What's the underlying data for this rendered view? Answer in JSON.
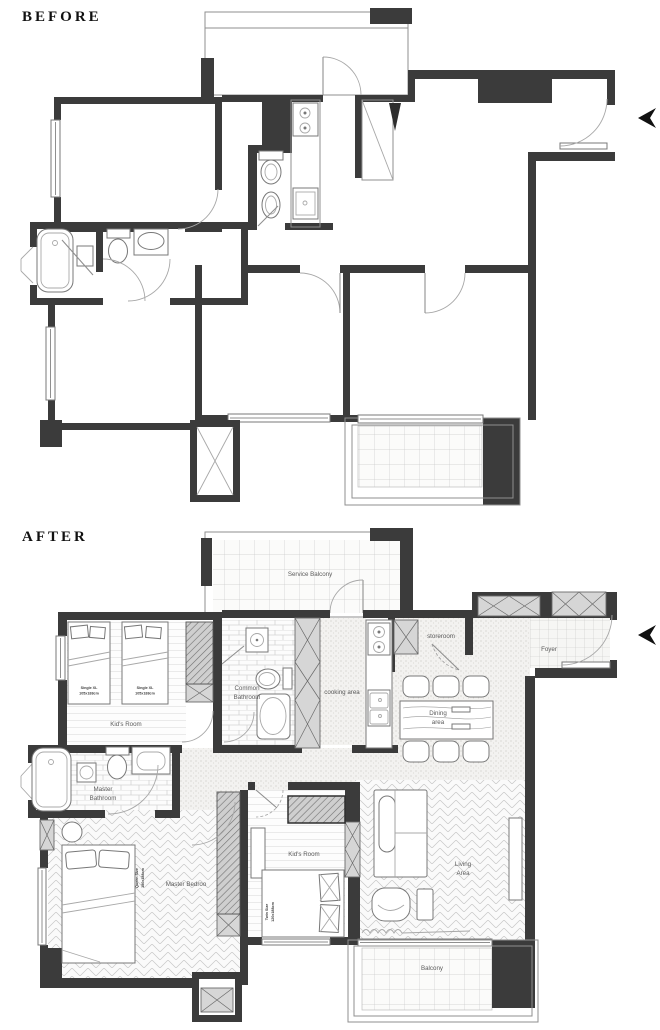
{
  "titles": {
    "before": "BEFORE",
    "after": "AFTER"
  },
  "after": {
    "rooms": {
      "service_balcony": "Service Balcony",
      "kids_room_1": "Kid's Room",
      "common_bathroom_line1": "Common",
      "common_bathroom_line2": "Bathroom",
      "cooking_area": "cooking area",
      "storeroom": "storeroom",
      "foyer": "Foyer",
      "dining_line1": "Dining",
      "dining_line2": "area",
      "master_bathroom_line1": "Master",
      "master_bathroom_line2": "Bathroom",
      "master_bedroom": "Master Bedroo",
      "kids_room_2": "Kid's Room",
      "living_line1": "Living",
      "living_line2": "Area",
      "balcony": "Balcony"
    },
    "furniture": {
      "single_bed_label": "Single XL",
      "single_bed_size": "105x188cm",
      "queen_bed_label": "Queen Size",
      "queen_bed_size": "180x188cm",
      "twin_bed_label": "Twin Size",
      "twin_bed_size": "120x188cm"
    }
  },
  "colors": {
    "wall": "#3b3b3b",
    "label": "#5a5a5a",
    "accent_arrow": "#111111"
  }
}
